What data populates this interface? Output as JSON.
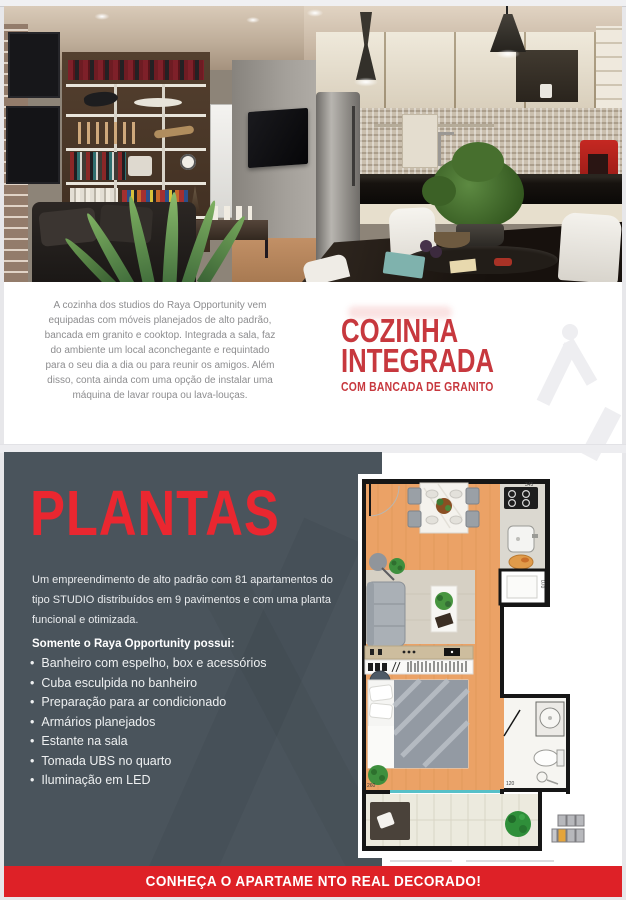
{
  "page": {
    "background": "#e7e7ea",
    "panel_dark": "#4a545c",
    "accent_red_dark": "#c7383e",
    "accent_red_bright": "#ea2730",
    "cta_red": "#de2127"
  },
  "cozinha_section": {
    "paragraph": "A cozinha dos studios do Raya Opportunity vem equipadas com móveis planejados de alto padrão, bancada em granito e cooktop. Integrada a sala, faz do ambiente um local aconchegante e requintado para o seu dia a dia ou para reunir os amigos. Além disso, conta ainda com uma opção de instalar uma máquina de lavar roupa ou lava-louças.",
    "title_line1": "COZINHA",
    "title_line2": "INTEGRADA",
    "subtitle": "COM BANCADA DE GRANITO"
  },
  "plantas_section": {
    "title": "PLANTAS",
    "intro": "Um empreendimento de alto padrão com 81 apartamentos do tipo STUDIO distribuídos em 9 pavimentos e com uma planta funcional e otimizada.",
    "features_heading": "Somente o Raya Opportunity possui:",
    "features": [
      "Banheiro com espelho, box e acessórios",
      "Cuba esculpida no banheiro",
      "Preparação para ar condicionado",
      "Armários planejados",
      "Estante na sala",
      "Tomada UBS no quarto",
      "Iluminação em LED"
    ]
  },
  "floor_plan": {
    "dims": {
      "top": "345",
      "service": "070",
      "bathroom": "120",
      "bedroom": "260",
      "balcony": "345"
    }
  },
  "cta": {
    "label": "CONHEÇA O APARTAME NTO REAL DECORADO!"
  }
}
